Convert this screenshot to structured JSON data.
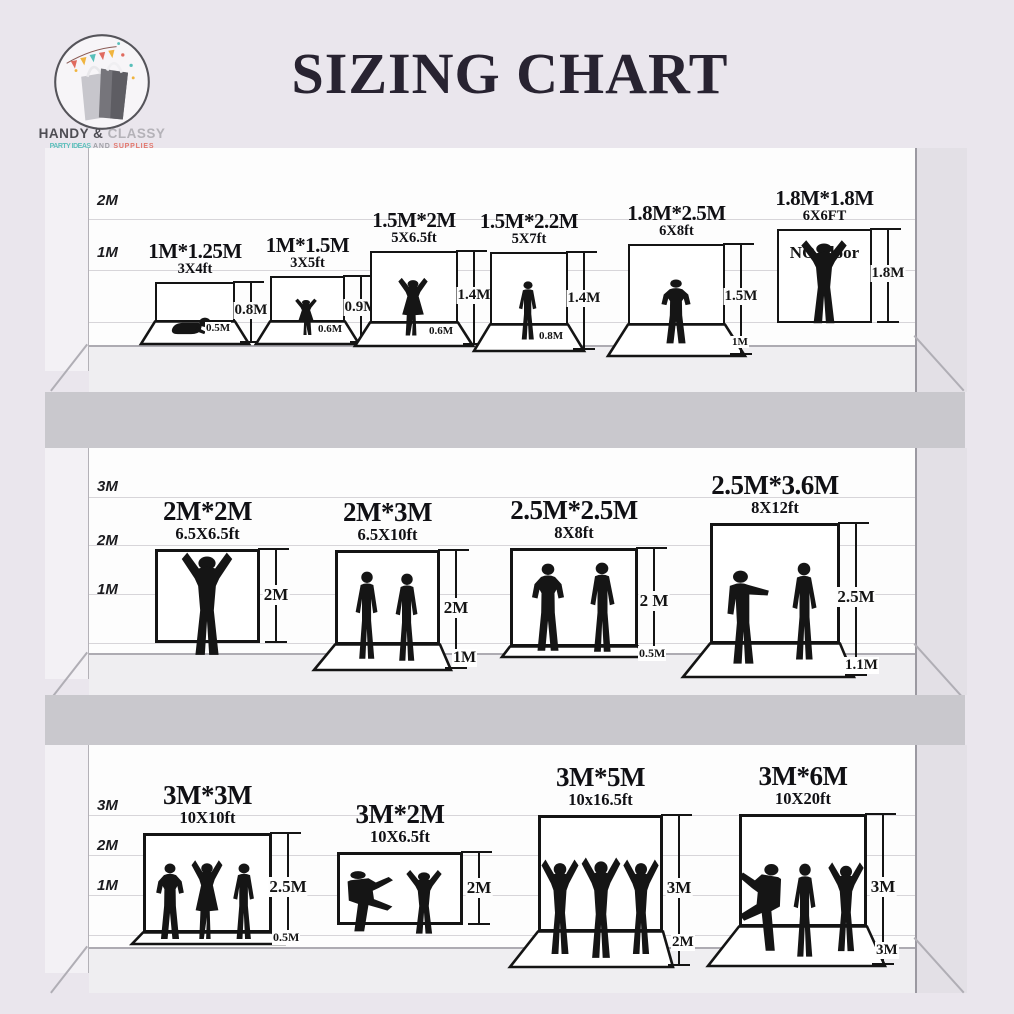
{
  "brand": {
    "name_part1": "HANDY &",
    "name_part2": "CLASSY",
    "tagline_part1": "PARTY IDEAS",
    "tagline_part2": " AND ",
    "tagline_part3": "SUPPLIES"
  },
  "title": "SIZING CHART",
  "rows": [
    {
      "scale": [
        "2M",
        "1M"
      ],
      "backdrops": [
        {
          "size": "1M*1.25M",
          "feet": "3X4ft",
          "height": "0.8M",
          "floor": "0.5M",
          "silhouette": "crawling-baby"
        },
        {
          "size": "1M*1.5M",
          "feet": "3X5ft",
          "height": "0.9M",
          "floor": "0.6M",
          "silhouette": "toddler-girl"
        },
        {
          "size": "1.5M*2M",
          "feet": "5X6.5ft",
          "height": "1.4M",
          "floor": "0.6M",
          "silhouette": "girl-arms-up"
        },
        {
          "size": "1.5M*2.2M",
          "feet": "5X7ft",
          "height": "1.4M",
          "floor": "0.8M",
          "silhouette": "standing-boy"
        },
        {
          "size": "1.8M*2.5M",
          "feet": "6X8ft",
          "height": "1.5M",
          "floor": "1M",
          "silhouette": "teen-hands-on-hips"
        },
        {
          "size": "1.8M*1.8M",
          "feet": "6X6FT",
          "height": "1.8M",
          "floor": null,
          "note": "NO Floor",
          "silhouette": "man-arms-raised"
        }
      ]
    },
    {
      "scale": [
        "3M",
        "2M",
        "1M"
      ],
      "backdrops": [
        {
          "size": "2M*2M",
          "feet": "6.5X6.5ft",
          "height": "2M",
          "floor": null,
          "silhouette": "cheering-man"
        },
        {
          "size": "2M*3M",
          "feet": "6.5X10ft",
          "height": "2M",
          "floor": "1M",
          "silhouette": "two-standing-men"
        },
        {
          "size": "2.5M*2.5M",
          "feet": "8X8ft",
          "height": "2 M",
          "floor": "0.5M",
          "silhouette": "two-men-talking"
        },
        {
          "size": "2.5M*3.6M",
          "feet": "8X12ft",
          "height": "2.5M",
          "floor": "1.1M",
          "silhouette": "two-men-gesturing"
        }
      ]
    },
    {
      "scale": [
        "3M",
        "2M",
        "1M"
      ],
      "backdrops": [
        {
          "size": "3M*3M",
          "feet": "10X10ft",
          "height": "2.5M",
          "floor": "0.5M",
          "silhouette": "three-friends"
        },
        {
          "size": "3M*2M",
          "feet": "10X6.5ft",
          "height": "2M",
          "floor": null,
          "silhouette": "two-dancers"
        },
        {
          "size": "3M*5M",
          "feet": "10x16.5ft",
          "height": "3M",
          "floor": "2M",
          "silhouette": "three-dancers"
        },
        {
          "size": "3M*6M",
          "feet": "10X20ft",
          "height": "3M",
          "floor": "3M",
          "silhouette": "three-performers"
        }
      ]
    }
  ]
}
